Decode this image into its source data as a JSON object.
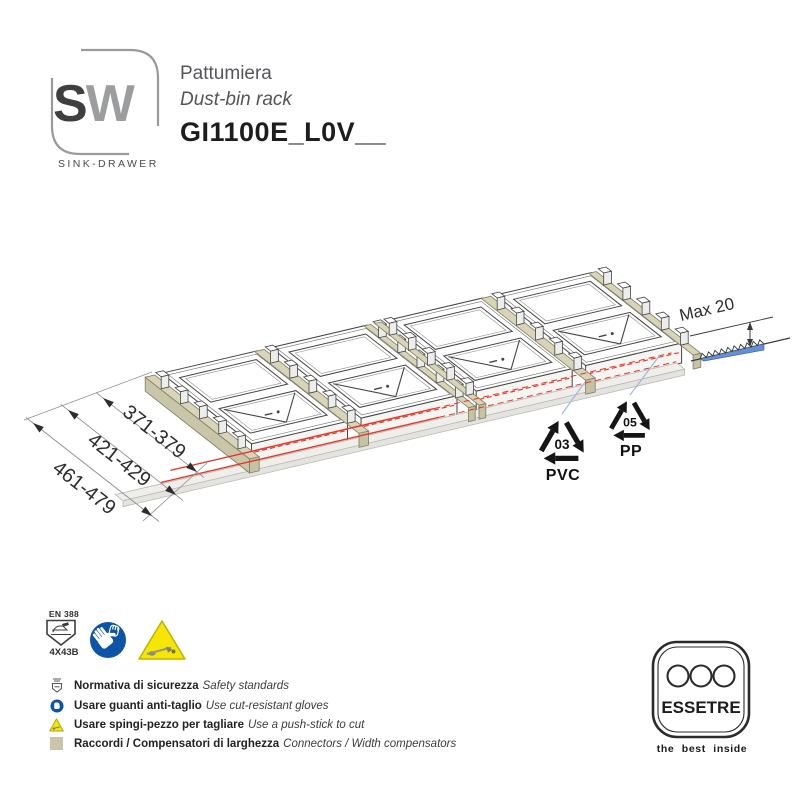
{
  "brand": {
    "logo_s": "S",
    "logo_w": "W",
    "caption": "SINK-DRAWER"
  },
  "header": {
    "title_it": "Pattumiera",
    "title_en": "Dust-bin rack",
    "code": "GI1100E_L0V__"
  },
  "drawing": {
    "width_options": [
      "371-379",
      "421-429",
      "461-479"
    ],
    "max_cut": "Max 20",
    "materials": [
      {
        "code": "03",
        "name": "PVC"
      },
      {
        "code": "05",
        "name": "PP"
      }
    ]
  },
  "safety": {
    "standard": "EN 388",
    "rating": "4X43B"
  },
  "legend": [
    {
      "it": "Normativa di sicurezza",
      "en": "Safety standards"
    },
    {
      "it": "Usare guanti anti-taglio",
      "en": "Use cut-resistant gloves"
    },
    {
      "it": "Usare spingi-pezzo per tagliare",
      "en": "Use a push-stick to cut"
    },
    {
      "it": "Raccordi / Compensatori di larghezza",
      "en": "Connectors / Width compensators"
    }
  ],
  "footer": {
    "brand": "ESSETRE",
    "tagline": "the best inside"
  },
  "colors": {
    "cut_line": "#e63323",
    "rail": "#d8d4b8",
    "saw": "#6591d2",
    "mandatory_blue": "#0d53a6",
    "warning_yellow": "#f6e604",
    "leader_blue": "#9fb8dc"
  }
}
